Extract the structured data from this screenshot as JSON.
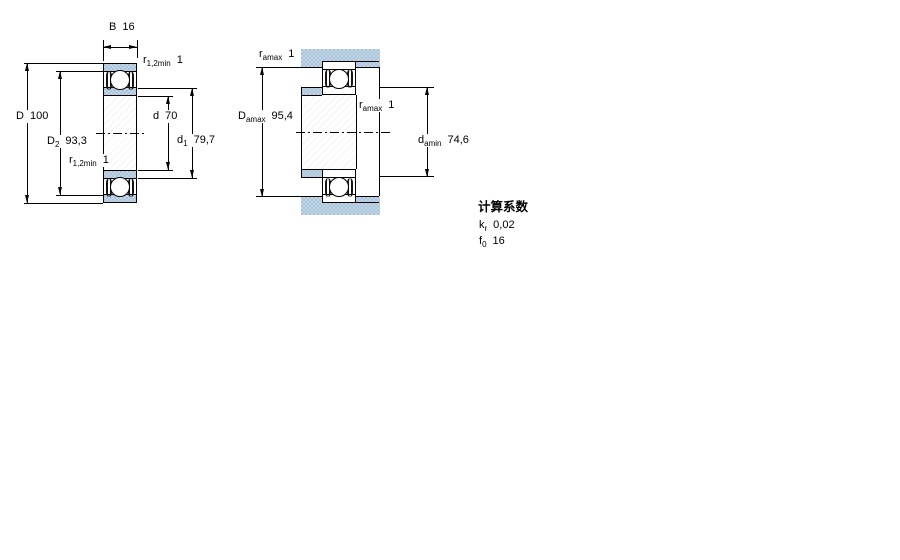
{
  "figure_left": {
    "b": {
      "base": "B",
      "value": "16"
    },
    "r_top": {
      "base": "r",
      "sub": "1,2min",
      "value": "1"
    },
    "r_bottom": {
      "base": "r",
      "sub": "1,2min",
      "value": "1"
    },
    "D": {
      "base": "D",
      "value": "100"
    },
    "D2": {
      "base": "D",
      "sub": "2",
      "value": "93,3"
    },
    "d": {
      "base": "d",
      "value": "70"
    },
    "d1": {
      "base": "d",
      "sub": "1",
      "value": "79,7"
    }
  },
  "figure_right": {
    "r_top": {
      "base": "r",
      "sub": "amax",
      "value": "1"
    },
    "Damax": {
      "base": "D",
      "sub": "amax",
      "value": "95,4"
    },
    "r_mid": {
      "base": "r",
      "sub": "amax",
      "value": "1"
    },
    "damin": {
      "base": "d",
      "sub": "amin",
      "value": "74,6"
    }
  },
  "calculation_factors": {
    "heading": "计算系数",
    "kr": {
      "base": "k",
      "sub": "r",
      "value": "0,02"
    },
    "f0": {
      "base": "f",
      "sub": "0",
      "value": "16"
    }
  },
  "colors": {
    "bearing_blue": "#a9c4db",
    "bearing_blue_light": "#c2d5e5",
    "line": "#000000"
  }
}
